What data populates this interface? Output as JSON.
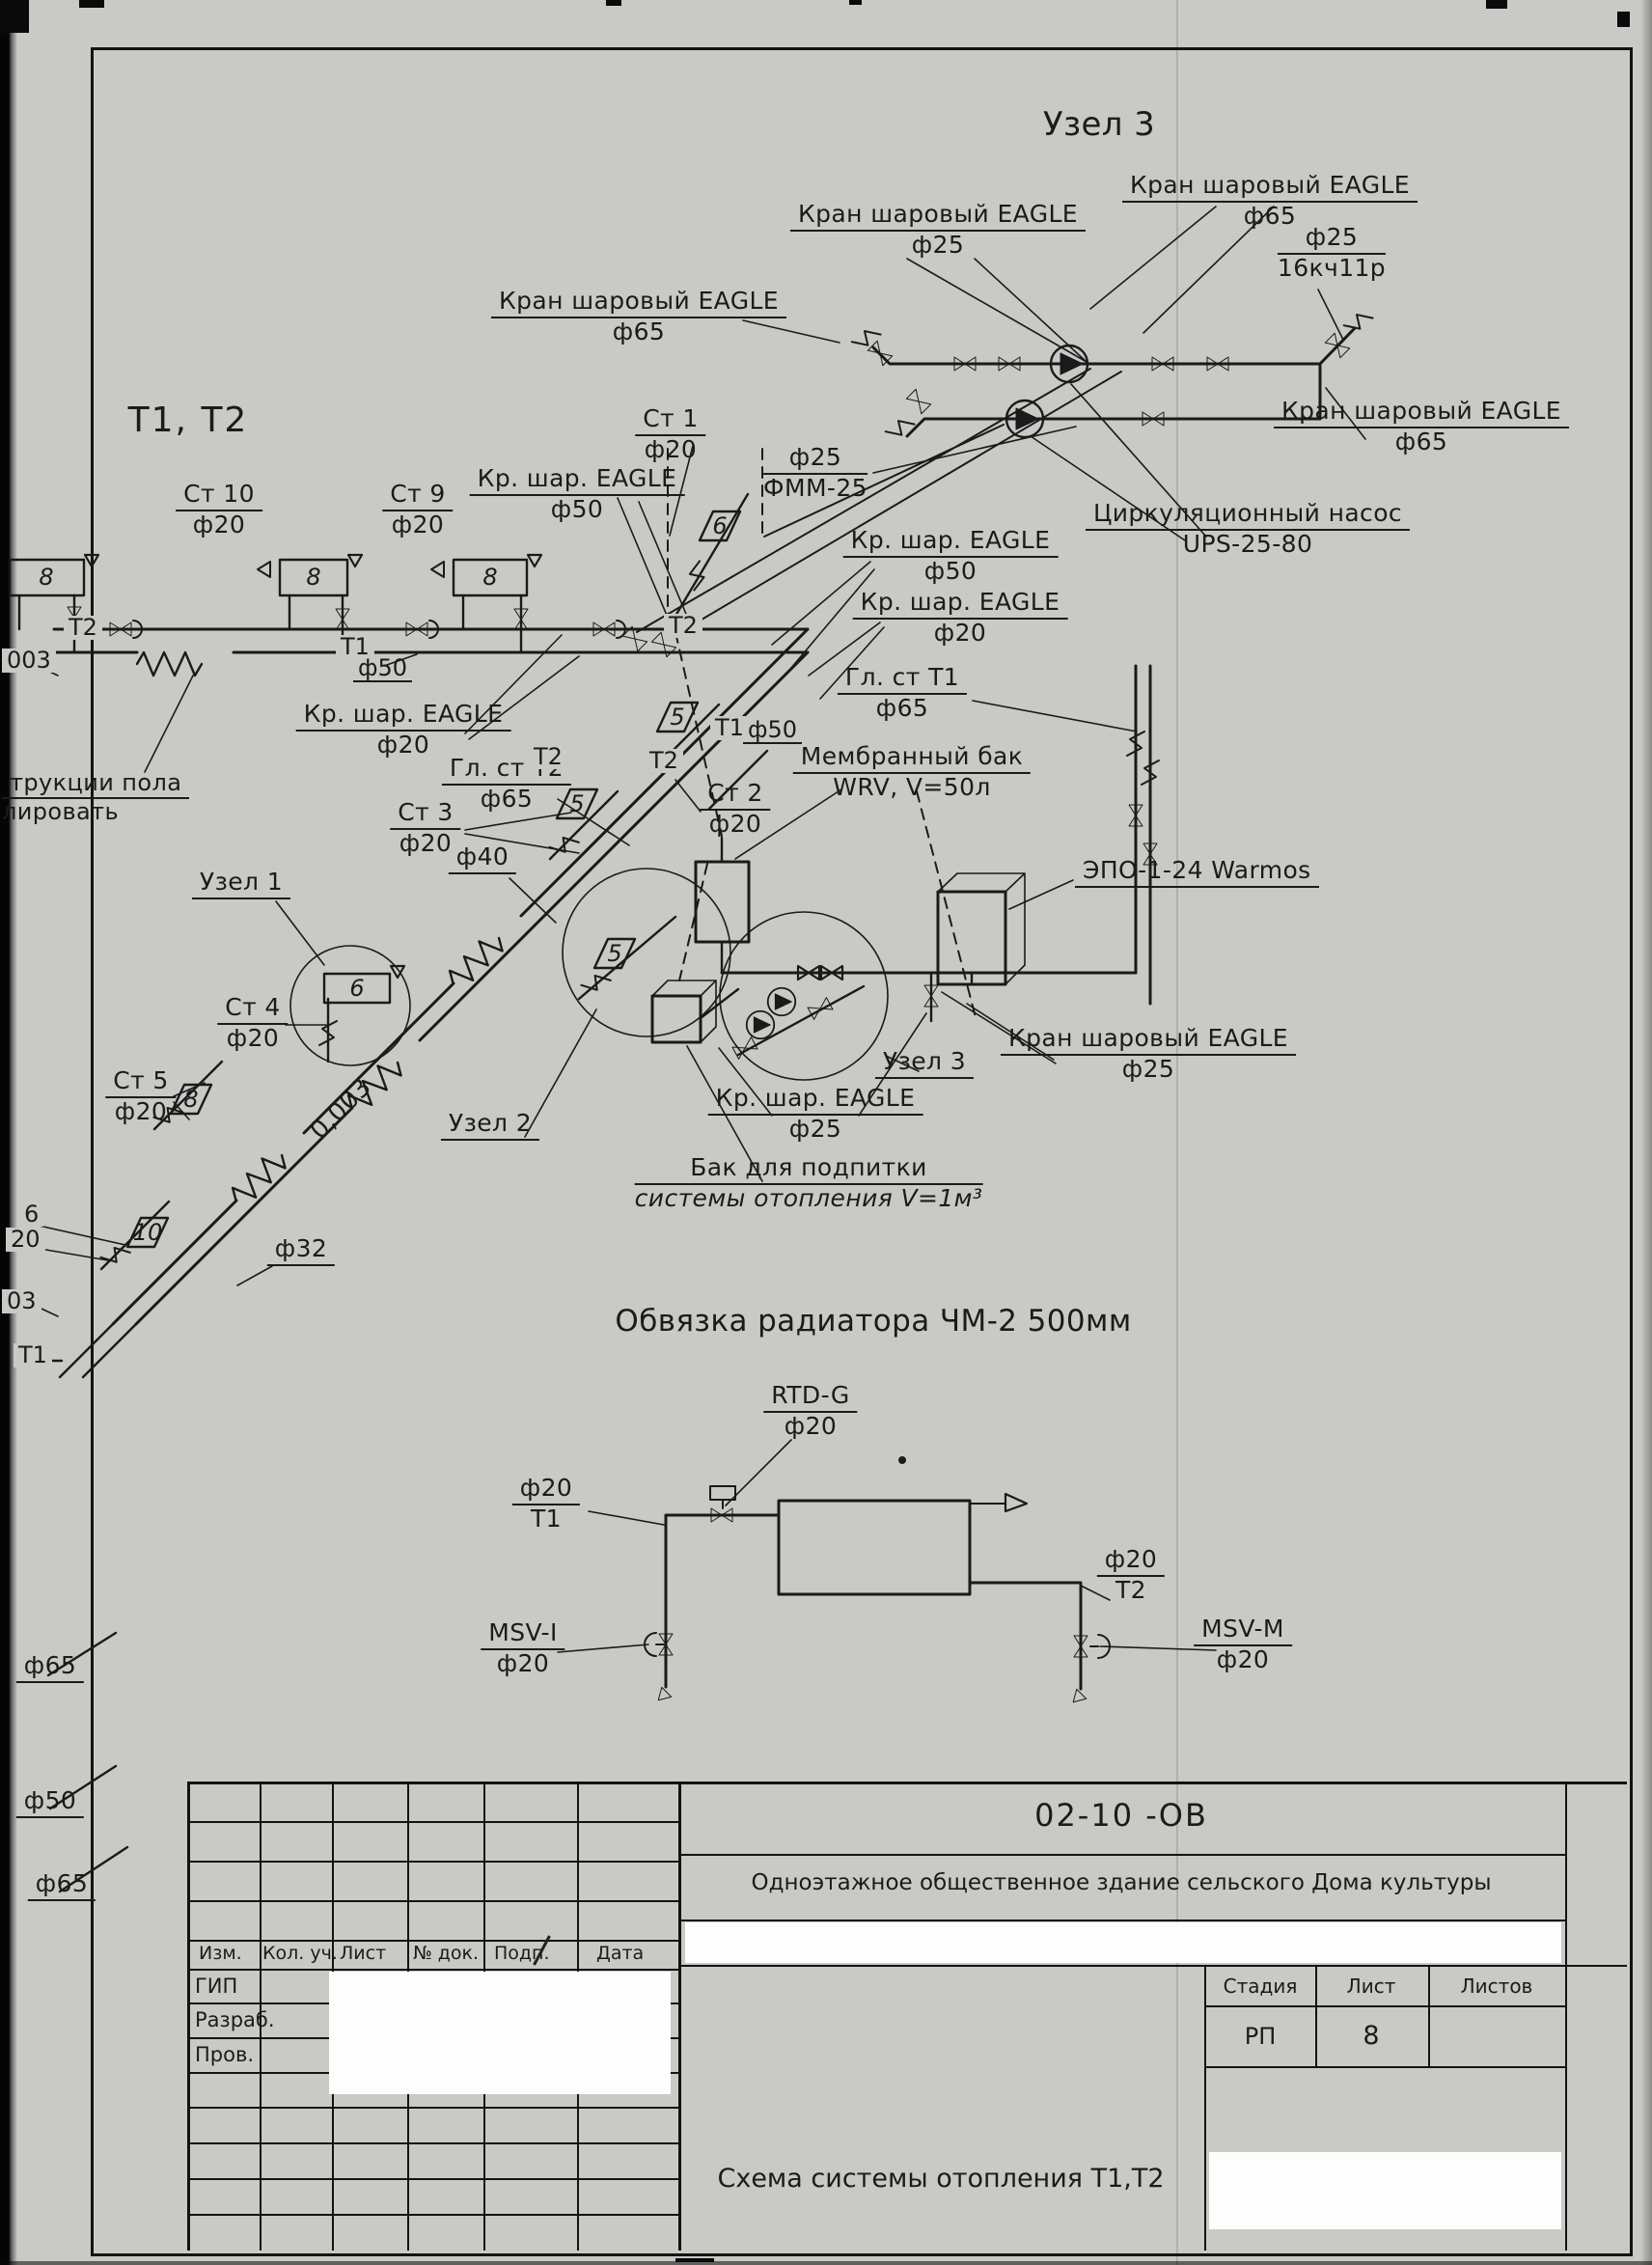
{
  "titles": {
    "uzel3_top": "Узел 3",
    "t1t2": "Т1, Т2",
    "obvyazka": "Обвязка радиатора ЧМ-2 500мм"
  },
  "terms": {
    "kran_sharovyi": "Кран шаровый EAGLE",
    "kr_shar": "Кр. шар. EAGLE",
    "f65": "ф65",
    "f50": "ф50",
    "f40": "ф40",
    "f32": "ф32",
    "f25": "ф25",
    "f20": "ф20",
    "v16": "16кч11р",
    "fmm": "ФММ-25",
    "pump1": "Циркуляционный насос",
    "pump2": "UPS-25-80",
    "st1": "Ст 1",
    "st2": "Ст 2",
    "st3": "Ст 3",
    "st4": "Ст 4",
    "st5": "Ст 5",
    "st9": "Ст 9",
    "st10": "Ст 10",
    "gl_t1": "Гл. ст Т1",
    "gl_t2": "Гл. ст Т2",
    "memb1": "Мембранный бак",
    "memb2": "WRV, V=50л",
    "epo": "ЭПО-1-24 Warmos",
    "uzel1": "Узел 1",
    "uzel2": "Узел 2",
    "uzel3": "Узел 3",
    "bak1": "Бак для подпитки",
    "bak2": "системы отопления V=1м³",
    "rtdg": "RTD-G",
    "msvi": "MSV-I",
    "msvm": "MSV-M",
    "t1": "Т1",
    "t2": "Т2",
    "slope": "0,003",
    "slope_a": "003",
    "slope_b": "03",
    "cut_pola": "трукции пола",
    "cut_izol": "лировать",
    "cut6": "6",
    "cut20": "20"
  },
  "symbols": {
    "n6": "6",
    "n5": "5",
    "n8": "8",
    "n10": "10"
  },
  "stamp": {
    "doc_number": "02-10 -ОВ",
    "object_title": "Одноэтажное общественное здание сельского Дома культуры",
    "drawing_title": "Схема системы отопления Т1,Т2",
    "cols": [
      "Изм.",
      "Кол. уч.",
      "Лист",
      "№ док.",
      "Подп.",
      "Дата"
    ],
    "roles": [
      "ГИП",
      "Разраб.",
      "Пров."
    ],
    "stage_h": "Стадия",
    "sheet_h": "Лист",
    "sheets_h": "Листов",
    "stage": "РП",
    "sheet_no": "8"
  }
}
